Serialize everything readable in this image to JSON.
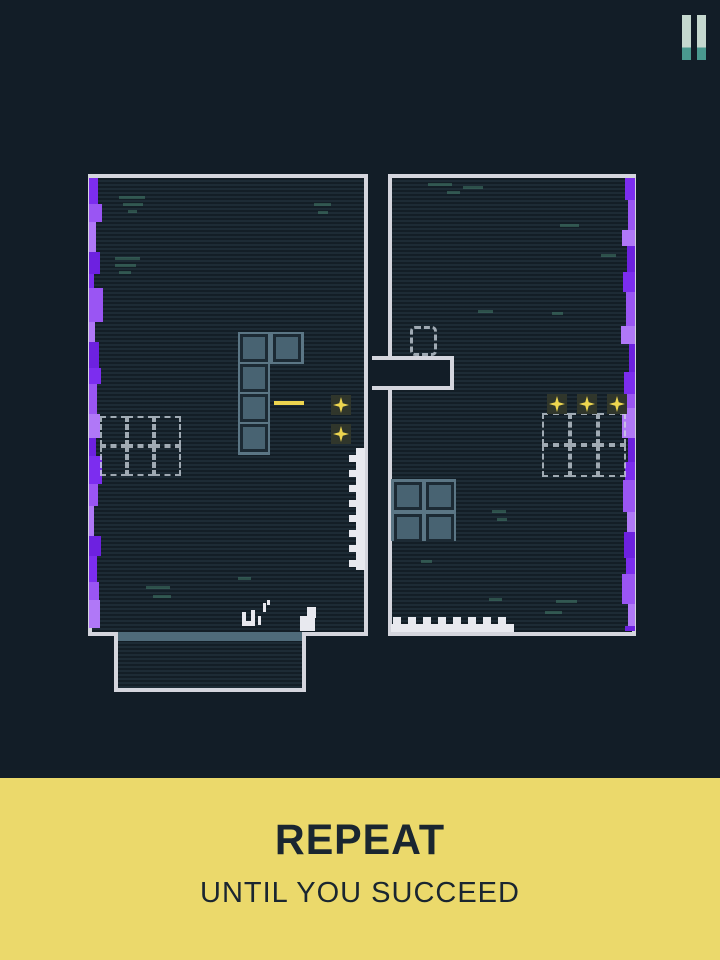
{
  "screen": {
    "width": 720,
    "height": 960,
    "bg": "#121d27"
  },
  "hud": {
    "pause_icon": "pause-icon"
  },
  "banner": {
    "title": "REPEAT",
    "subtitle": "UNTIL YOU SUCCEED",
    "bg": "#ebd96b",
    "fg": "#1a2630"
  },
  "palette": {
    "room_fill": "#1d2b35",
    "scan": "rgba(7,13,19,0.45)",
    "border": "#d4d5dd",
    "plate": "#5b7685",
    "ring": "#1c2a34",
    "core": "#486372",
    "ghost": "rgba(206,215,224,0.75)",
    "gold": "#edd54f",
    "gold_back": "#30362b",
    "white": "#e8e9ef",
    "decor": "rgba(80,150,125,0.42)",
    "tray_band": "#4f6b7a",
    "pause_top": "#c5d8cf",
    "pause_bottom": "#4a998f"
  },
  "scene": {
    "purple_colors": [
      "#7c2def",
      "#9a55f3",
      "#b078f7",
      "#6d21e0"
    ],
    "rooms": [
      {
        "name": "room-left",
        "x": 88,
        "y": 174,
        "w": 280,
        "h": 462
      },
      {
        "name": "room-right",
        "x": 388,
        "y": 174,
        "w": 248,
        "h": 462
      }
    ],
    "tray": {
      "x": 114,
      "y": 632,
      "w": 192,
      "h": 60,
      "band_h": 9
    },
    "notch": {
      "x": 372,
      "y": 356,
      "w": 82,
      "h": 34
    },
    "ghost_door": {
      "x": 410,
      "y": 326,
      "w": 27,
      "h": 30
    },
    "plates": [
      {
        "x": 238,
        "y": 332,
        "w": 32,
        "h": 123
      },
      {
        "x": 270,
        "y": 332,
        "w": 34,
        "h": 32
      },
      {
        "x": 391,
        "y": 479,
        "w": 65,
        "h": 62
      }
    ],
    "block_cells": [
      [
        240,
        334
      ],
      [
        273,
        334
      ],
      [
        240,
        364
      ],
      [
        240,
        394
      ],
      [
        240,
        424
      ],
      [
        394,
        482
      ],
      [
        426,
        482
      ],
      [
        394,
        514
      ],
      [
        426,
        514
      ]
    ],
    "cell_size": 28,
    "ghost_grids": [
      {
        "x": 100,
        "y": 416,
        "cols": 3,
        "rows": 2,
        "cw": 27,
        "ch": 30
      },
      {
        "x": 542,
        "y": 413,
        "cols": 3,
        "rows": 2,
        "cw": 28,
        "ch": 32
      }
    ],
    "collectibles": [
      [
        331,
        395
      ],
      [
        331,
        424
      ],
      [
        547,
        394
      ],
      [
        577,
        394
      ],
      [
        607,
        394
      ]
    ],
    "collectible_back": 20,
    "collectible_star": 16,
    "beam": {
      "x": 274,
      "y": 401,
      "w": 30,
      "h": 4
    },
    "zipper": {
      "base": {
        "x": 356,
        "y": 448,
        "w": 9,
        "h": 122
      },
      "teeth_x": 349,
      "tw": 8,
      "th": 7,
      "teeth_y": [
        455,
        470,
        485,
        500,
        515,
        530,
        545,
        560
      ]
    },
    "bumps": {
      "base": {
        "x": 391,
        "y": 624,
        "w": 123,
        "h": 8
      },
      "teeth_y": 617,
      "tw": 8,
      "th": 8,
      "teeth_x": [
        393,
        408,
        423,
        438,
        453,
        468,
        483,
        498
      ]
    },
    "step": [
      [
        307,
        607,
        9,
        11
      ],
      [
        300,
        616,
        15,
        15
      ]
    ],
    "player": [
      [
        242,
        612,
        4,
        14
      ],
      [
        246,
        621,
        7,
        5
      ],
      [
        251,
        610,
        4,
        16
      ],
      [
        258,
        616,
        3,
        9
      ],
      [
        263,
        603,
        3,
        9
      ],
      [
        267,
        600,
        3,
        5
      ]
    ],
    "purple_strips": [
      {
        "anchor": "left",
        "x": 89,
        "top": 178,
        "bottom": 628,
        "heights": [
          26,
          18,
          30,
          22,
          14,
          34,
          20,
          26,
          16,
          30,
          24,
          18,
          28,
          22,
          30,
          20,
          26,
          18,
          30
        ],
        "widths": [
          9,
          13,
          7,
          11,
          5,
          14,
          6,
          10,
          12,
          8,
          11,
          7,
          13,
          9,
          5,
          12,
          8,
          10,
          11
        ]
      },
      {
        "anchor": "right",
        "x": 635,
        "top": 178,
        "bottom": 631,
        "heights": [
          22,
          30,
          16,
          26,
          20,
          34,
          18,
          28,
          22,
          14,
          30,
          24,
          18,
          32,
          20,
          26,
          16,
          30,
          22
        ],
        "widths": [
          10,
          7,
          13,
          8,
          12,
          9,
          14,
          6,
          11,
          8,
          13,
          7,
          10,
          12,
          8,
          11,
          9,
          13,
          7
        ]
      }
    ],
    "decor": [
      [
        119,
        196,
        26
      ],
      [
        123,
        203,
        20
      ],
      [
        128,
        210,
        9
      ],
      [
        314,
        203,
        17
      ],
      [
        318,
        211,
        10
      ],
      [
        115,
        257,
        25
      ],
      [
        115,
        264,
        21
      ],
      [
        119,
        271,
        12
      ],
      [
        146,
        586,
        24
      ],
      [
        153,
        595,
        18
      ],
      [
        238,
        577,
        13
      ],
      [
        428,
        183,
        24
      ],
      [
        447,
        191,
        13
      ],
      [
        463,
        186,
        20
      ],
      [
        560,
        224,
        19
      ],
      [
        601,
        254,
        15
      ],
      [
        478,
        310,
        15
      ],
      [
        552,
        312,
        11
      ],
      [
        492,
        510,
        14
      ],
      [
        497,
        518,
        10
      ],
      [
        556,
        600,
        21
      ],
      [
        545,
        611,
        17
      ],
      [
        489,
        598,
        13
      ],
      [
        421,
        560,
        11
      ]
    ]
  }
}
